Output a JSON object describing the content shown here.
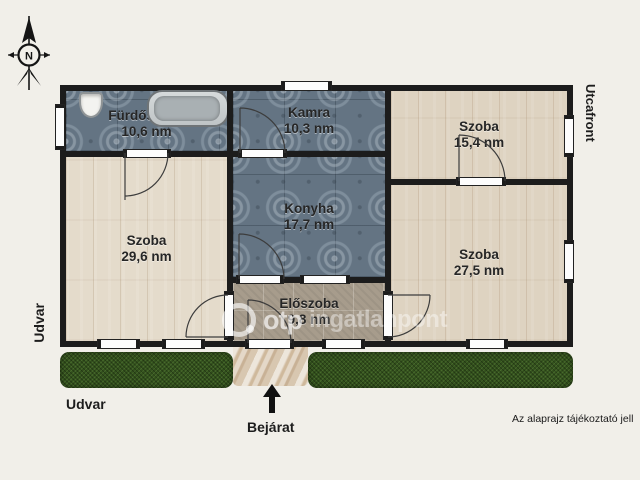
{
  "rooms": [
    {
      "name": "Fürdőszoba",
      "area": "10,6 nm"
    },
    {
      "name": "Kamra",
      "area": "10,3 nm"
    },
    {
      "name": "Szoba",
      "area": "15,4 nm"
    },
    {
      "name": "Konyha",
      "area": "17,7 nm"
    },
    {
      "name": "Szoba",
      "area": "29,6 nm"
    },
    {
      "name": "Előszoba",
      "area": "9,8 nm"
    },
    {
      "name": "Szoba",
      "area": "27,5 nm"
    }
  ],
  "outside_labels": {
    "street_front": "Utcafront",
    "yard_side": "Udvar",
    "yard_bottom": "Udvar",
    "entrance": "Bejárat"
  },
  "compass": {
    "north_letter": "N"
  },
  "watermark": {
    "logo_text": "otp",
    "brand_text": "ingatlanpont"
  },
  "disclaimer": "Az alaprajz tájékoztató jell",
  "colors": {
    "background": "#f1efe9",
    "wall": "#1c1c1c",
    "tile_blue": "#647483",
    "wood": "#ded3c1",
    "tile_taupe": "#a79c8c",
    "grass": "#33511d",
    "path": "#d8c7b0"
  }
}
